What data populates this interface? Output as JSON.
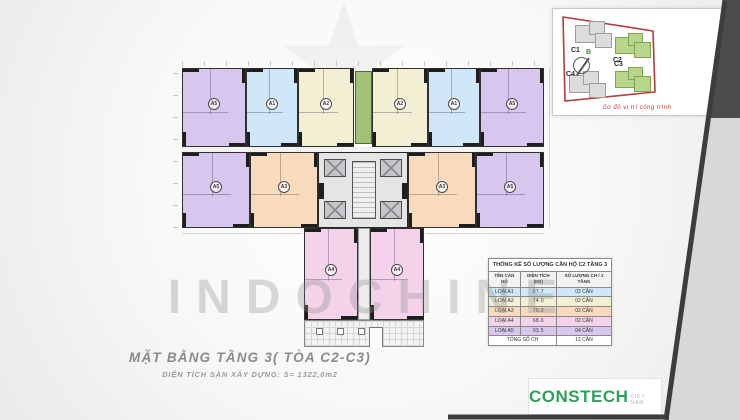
{
  "watermark": {
    "text": "INDOCHINE",
    "star": "★"
  },
  "site_map": {
    "caption": "Sơ đồ vị trí công trình",
    "compass_label": "B",
    "buildings": [
      {
        "label": "C1",
        "highlighted": false
      },
      {
        "label": "C2",
        "highlighted": true
      },
      {
        "label": "C3",
        "highlighted": true
      },
      {
        "label": "C4",
        "highlighted": false
      }
    ],
    "outline_color": "#b43b3b",
    "highlight_color": "#b9d48b"
  },
  "plan": {
    "palette": {
      "purple": "#d7c6ee",
      "blue": "#cfe7f7",
      "cream": "#f3efd5",
      "orange": "#f8dbbd",
      "pink": "#f4d2e9",
      "green_core": "#a3c077",
      "gray_core": "#e6e4e6"
    },
    "units": [
      {
        "label": "A5"
      },
      {
        "label": "A1"
      },
      {
        "label": "A2"
      },
      {
        "label": "A2"
      },
      {
        "label": "A1"
      },
      {
        "label": "A5"
      },
      {
        "label": "A5"
      },
      {
        "label": "A3"
      },
      {
        "label": "A3"
      },
      {
        "label": "A5"
      },
      {
        "label": "A4"
      },
      {
        "label": "A4"
      }
    ]
  },
  "table": {
    "title": "THỐNG KÊ SỐ LƯỢNG CĂN HỘ C2 TẦNG 3",
    "headers": [
      "TÊN CĂN HỘ",
      "DIỆN TÍCH (M2)",
      "SỐ LƯỢNG CH / 1 TẦNG"
    ],
    "rows": [
      {
        "name": "LOẠI A1",
        "area": "67.7",
        "count": "02 CĂN",
        "color": "#cfe7f7"
      },
      {
        "name": "LOẠI A2",
        "area": "74.0",
        "count": "02 CĂN",
        "color": "#f3efd5"
      },
      {
        "name": "LOẠI A3",
        "area": "76.2",
        "count": "02 CĂN",
        "color": "#f8dbbd"
      },
      {
        "name": "LOẠI A4",
        "area": "68.6",
        "count": "02 CĂN",
        "color": "#f4d2e9"
      },
      {
        "name": "LOẠI A5",
        "area": "93.5",
        "count": "04 CĂN",
        "color": "#d7c6ee"
      }
    ],
    "total": {
      "name": "TỔNG SỐ CH",
      "count": "12 CĂN"
    }
  },
  "titles": {
    "main": "MẶT BẰNG TẦNG 3( TÒA C2-C3)",
    "sub": "DIỆN TÍCH SÀN XÂY DỰNG: S= 1322,0m2"
  },
  "logo": {
    "brand": "CONSTECH",
    "suffix": "VIET NAM",
    "brand_color": "#2fa05c"
  }
}
